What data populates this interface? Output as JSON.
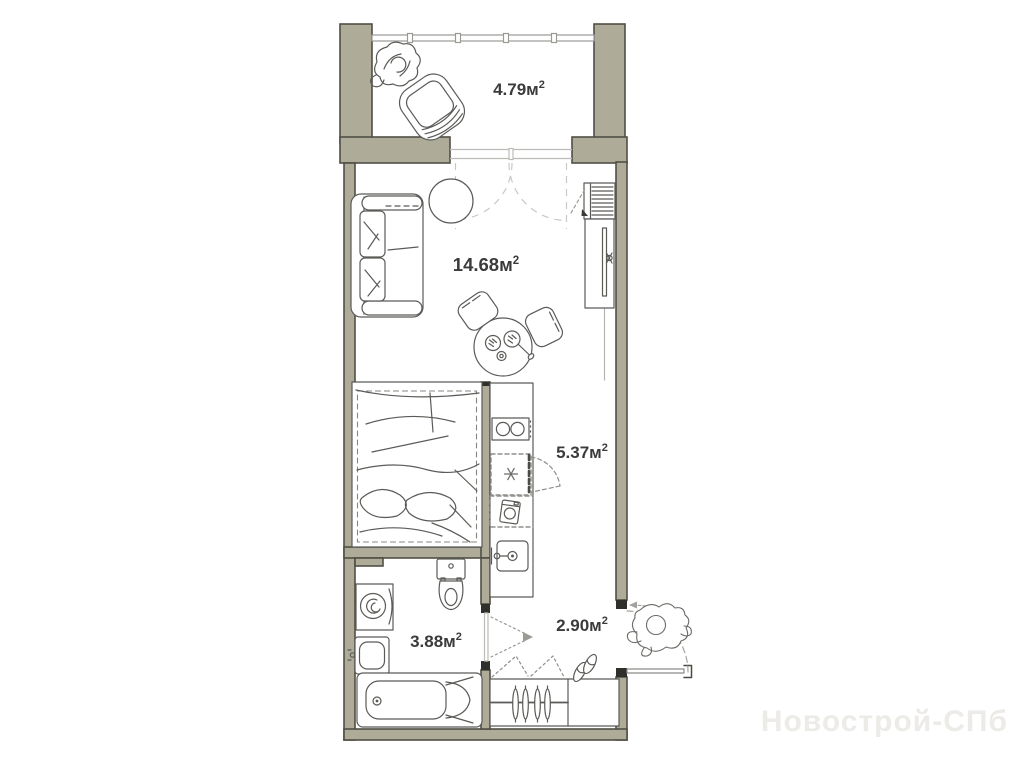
{
  "plan": {
    "rooms": {
      "balcony": {
        "area_label": "4.79м",
        "sup": "2"
      },
      "living": {
        "area_label": "14.68м",
        "sup": "2"
      },
      "kitchen": {
        "area_label": "5.37м",
        "sup": "2"
      },
      "bathroom": {
        "area_label": "3.88м",
        "sup": "2"
      },
      "hallway": {
        "area_label": "2.90м",
        "sup": "2"
      }
    },
    "watermark": "Новострой-СПб",
    "colors": {
      "wall_fill": "#aeab98",
      "wall_outline": "#504f46",
      "door_jamb": "#2f2f2b",
      "furniture_line": "#5a5a57",
      "swing_dash": "#c9c8c3",
      "label_text": "#3b3b3b",
      "watermark_text": "#edebe7"
    }
  }
}
